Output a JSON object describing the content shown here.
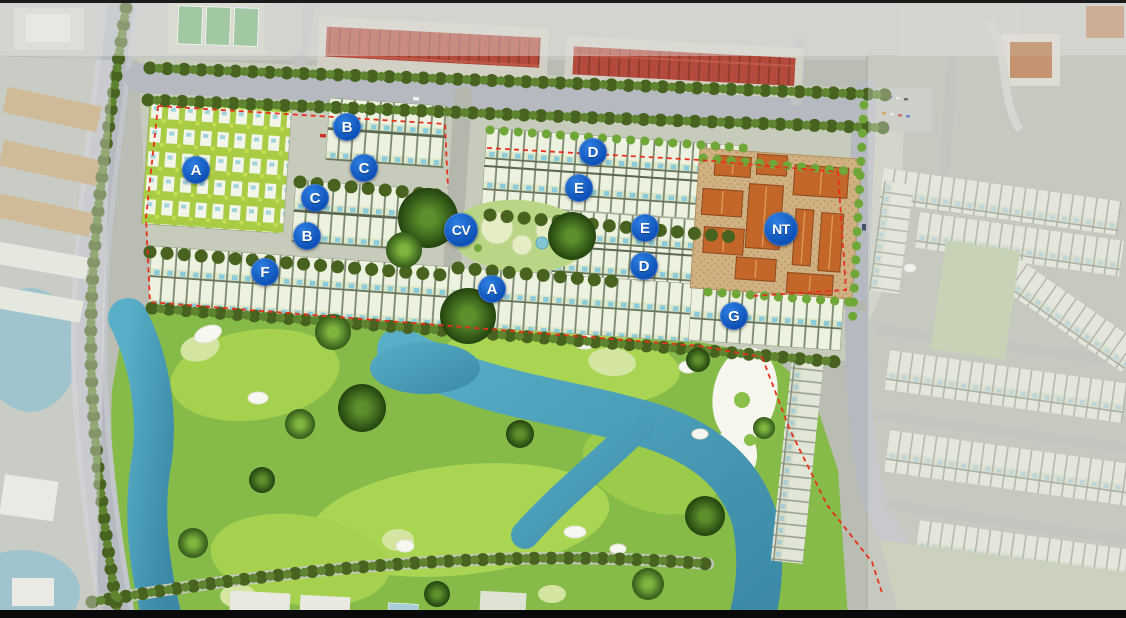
{
  "map": {
    "name": "resort-master-plan",
    "description": "Aerial master plan with golf course, villa rows and facility blocks"
  },
  "markers": [
    {
      "label": "A",
      "x": 196,
      "y": 170,
      "size": "sm"
    },
    {
      "label": "B",
      "x": 347,
      "y": 127,
      "size": "sm"
    },
    {
      "label": "C",
      "x": 364,
      "y": 168,
      "size": "sm"
    },
    {
      "label": "C",
      "x": 315,
      "y": 198,
      "size": "sm"
    },
    {
      "label": "B",
      "x": 307,
      "y": 236,
      "size": "sm"
    },
    {
      "label": "CV",
      "x": 461,
      "y": 230,
      "size": "lg"
    },
    {
      "label": "D",
      "x": 593,
      "y": 152,
      "size": "sm"
    },
    {
      "label": "E",
      "x": 579,
      "y": 188,
      "size": "sm"
    },
    {
      "label": "E",
      "x": 645,
      "y": 228,
      "size": "sm"
    },
    {
      "label": "D",
      "x": 644,
      "y": 266,
      "size": "sm"
    },
    {
      "label": "F",
      "x": 265,
      "y": 272,
      "size": "sm"
    },
    {
      "label": "A",
      "x": 492,
      "y": 289,
      "size": "sm"
    },
    {
      "label": "G",
      "x": 734,
      "y": 316,
      "size": "sm"
    },
    {
      "label": "NT",
      "x": 781,
      "y": 229,
      "size": "lg"
    }
  ],
  "colors": {
    "marker_blue": "#0d55c0",
    "boundary_red": "#e8301a",
    "water_teal": "#4a9cb5",
    "golf_green": "#86bb49",
    "roof_orange": "#c2662a",
    "roof_red": "#b0473a"
  }
}
